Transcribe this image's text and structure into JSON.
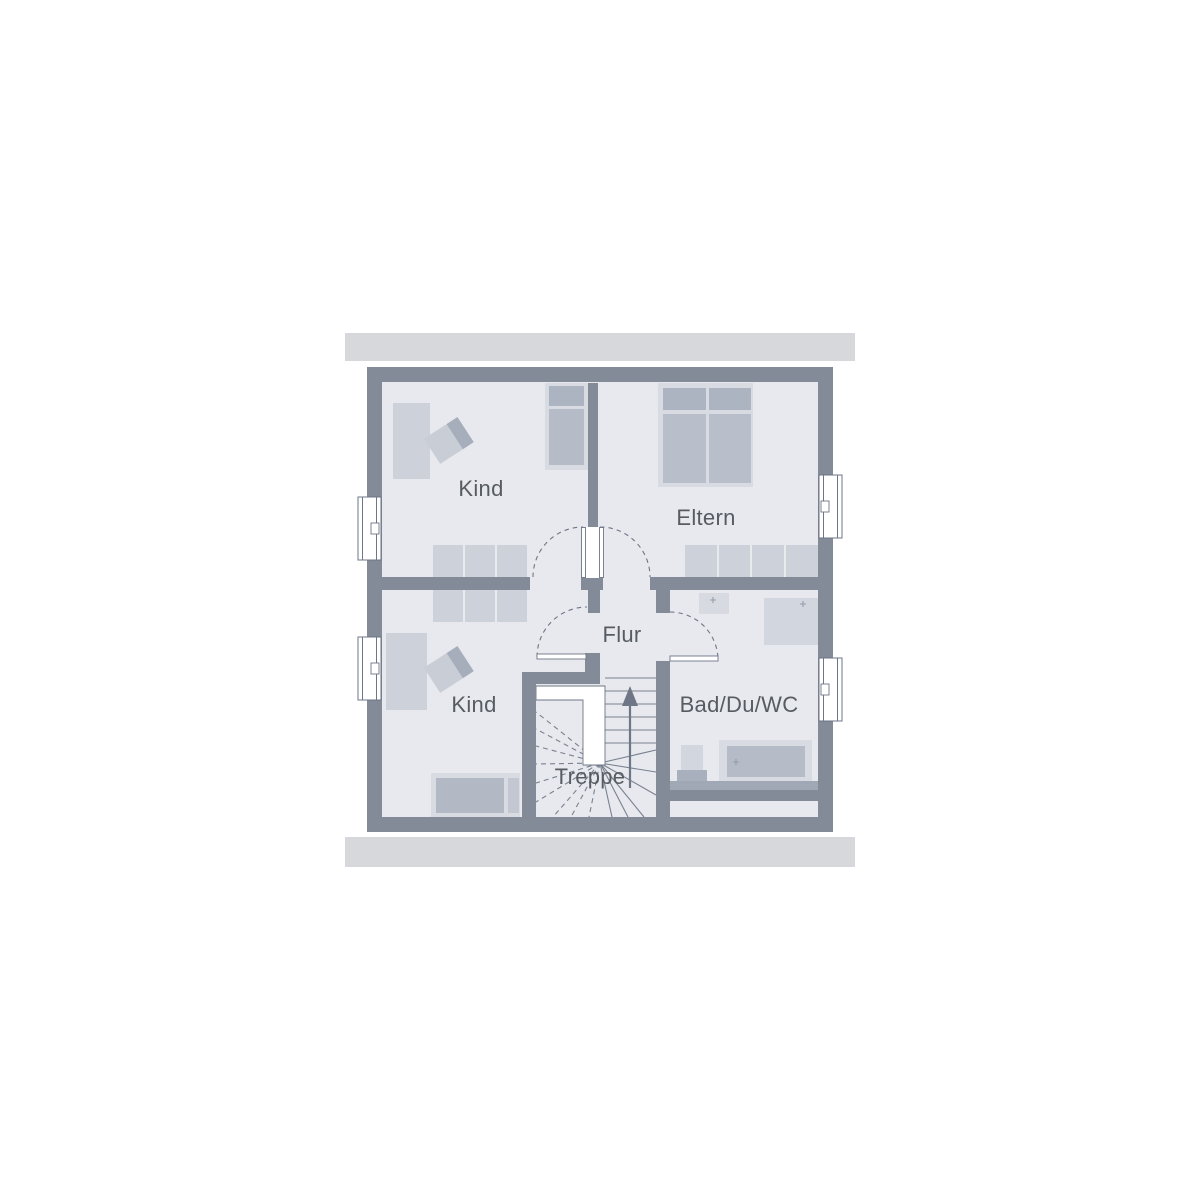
{
  "plan": {
    "type": "floor-plan",
    "rooms": [
      {
        "id": "kind-upper",
        "label": "Kind"
      },
      {
        "id": "eltern",
        "label": "Eltern"
      },
      {
        "id": "flur",
        "label": "Flur"
      },
      {
        "id": "kind-lower",
        "label": "Kind"
      },
      {
        "id": "treppe",
        "label": "Treppe"
      },
      {
        "id": "bad",
        "label": "Bad/Du/WC"
      }
    ]
  },
  "icons": {
    "stair_direction_arrow": "up-arrow",
    "window": "double-frame-window-symbol",
    "door": "quarter-circle-swing"
  },
  "colors": {
    "background": "#ffffff",
    "wall": "#838b99",
    "room": "#e7e9ee",
    "roof_band": "#d7d8dc",
    "line": "#6e7686",
    "text": "#575c63",
    "furniture_light": "#cdd2da",
    "furniture_frame": "#d8dbe1",
    "furniture_medium": "#b5bcc8",
    "furniture_dark": "#a7aebb"
  }
}
